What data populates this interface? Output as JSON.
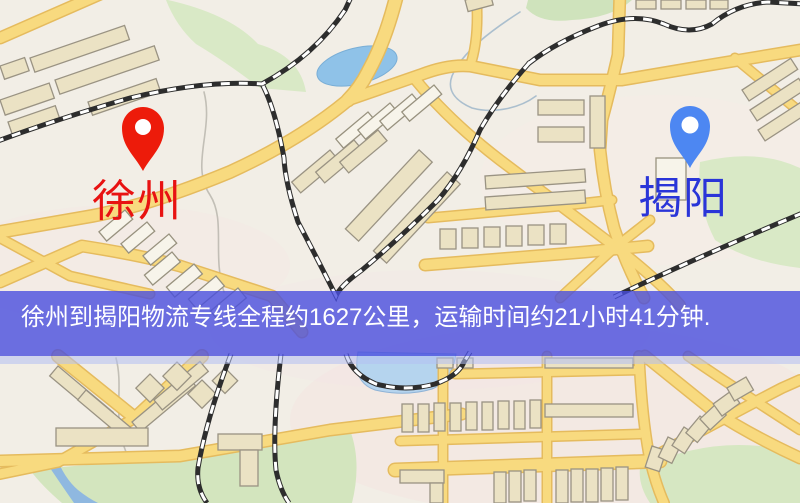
{
  "map": {
    "origin": {
      "name": "徐州",
      "marker_color": "#ed1b0a",
      "label_color": "#e81212"
    },
    "destination": {
      "name": "揭阳",
      "marker_color": "#4d87f2",
      "label_color": "#2a35d8"
    },
    "banner": {
      "text": "徐州到揭阳物流专线全程约1627公里，运输时间约21小时41分钟.",
      "background_color": "#484ede",
      "text_color": "#ffffff"
    },
    "route": {
      "origin_city": "徐州",
      "destination_city": "揭阳",
      "distance_km": "1627",
      "duration": "21小时41分钟"
    },
    "legend_colors": {
      "road": "#f8da7f",
      "railway": "#2d2d2d",
      "water": "#8fc2e8",
      "park": "#d9e9c6",
      "building": "#ebe2c4",
      "background": "#f2eee6"
    }
  }
}
